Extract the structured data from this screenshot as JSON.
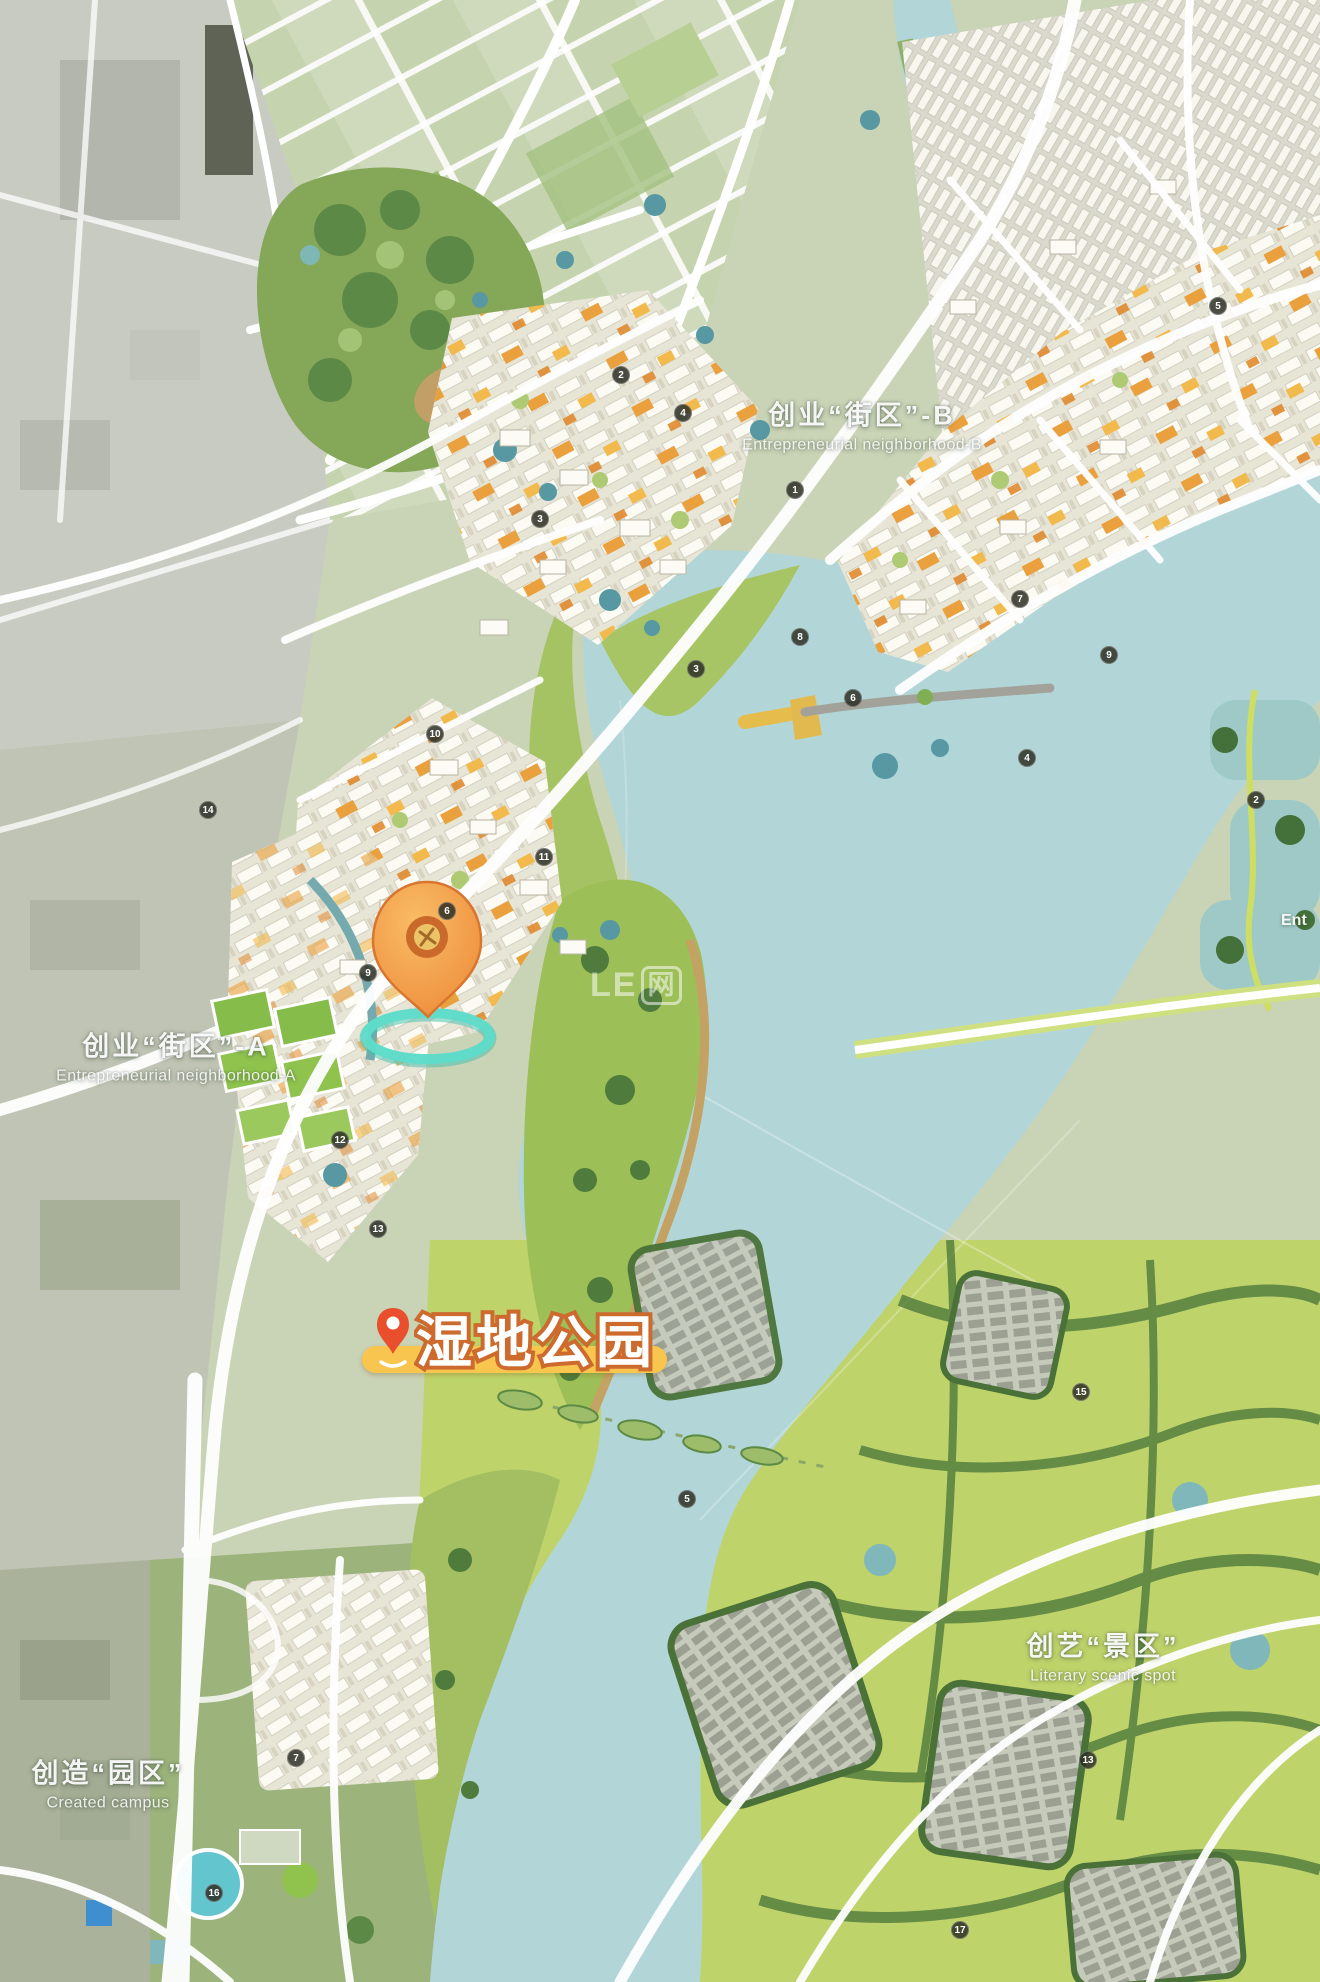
{
  "meta": {
    "canvas": {
      "width": 1320,
      "height": 1982
    },
    "kind": "urban master-plan rendering with wetland-park location tag"
  },
  "districts": [
    {
      "id": "district-b",
      "zh": "创业“街区”-B",
      "en": "Entrepreneurial neighborhood-B",
      "x": 862,
      "y": 424
    },
    {
      "id": "district-a",
      "zh": "创业“街区”-A",
      "en": "Entrepreneurial neighborhood-A",
      "x": 176,
      "y": 1055
    },
    {
      "id": "scenic-area",
      "zh": "创艺“景区”",
      "en": "Literary scenic spot",
      "x": 1103,
      "y": 1655
    },
    {
      "id": "campus",
      "zh": "创造“园区”",
      "en": "Created campus",
      "x": 108,
      "y": 1782
    }
  ],
  "edge_label": {
    "text": "Ent",
    "x": 1281,
    "y": 912
  },
  "poi_tag": {
    "text": "湿地公园"
  },
  "watermark": {
    "latin": "LE",
    "cjk": "网"
  },
  "pin": {
    "x": 427,
    "y": 1016
  },
  "markers": [
    {
      "x": 621,
      "y": 375,
      "n": "2"
    },
    {
      "x": 683,
      "y": 413,
      "n": "4"
    },
    {
      "x": 795,
      "y": 490,
      "n": "1"
    },
    {
      "x": 540,
      "y": 519,
      "n": "3"
    },
    {
      "x": 696,
      "y": 669,
      "n": "3"
    },
    {
      "x": 800,
      "y": 637,
      "n": "8"
    },
    {
      "x": 853,
      "y": 698,
      "n": "6"
    },
    {
      "x": 1027,
      "y": 758,
      "n": "4"
    },
    {
      "x": 1020,
      "y": 599,
      "n": "7"
    },
    {
      "x": 1109,
      "y": 655,
      "n": "9"
    },
    {
      "x": 1256,
      "y": 800,
      "n": "2"
    },
    {
      "x": 1218,
      "y": 306,
      "n": "5"
    },
    {
      "x": 435,
      "y": 734,
      "n": "10"
    },
    {
      "x": 208,
      "y": 810,
      "n": "14"
    },
    {
      "x": 544,
      "y": 857,
      "n": "11"
    },
    {
      "x": 447,
      "y": 911,
      "n": "6"
    },
    {
      "x": 368,
      "y": 973,
      "n": "9"
    },
    {
      "x": 340,
      "y": 1140,
      "n": "12"
    },
    {
      "x": 378,
      "y": 1229,
      "n": "13"
    },
    {
      "x": 687,
      "y": 1499,
      "n": "5"
    },
    {
      "x": 1081,
      "y": 1392,
      "n": "15"
    },
    {
      "x": 1088,
      "y": 1760,
      "n": "13"
    },
    {
      "x": 296,
      "y": 1758,
      "n": "7"
    },
    {
      "x": 214,
      "y": 1893,
      "n": "16"
    },
    {
      "x": 960,
      "y": 1930,
      "n": "17"
    }
  ],
  "colors": {
    "water": "#b2d6d8",
    "tag_bg": "#f8c64e",
    "tag_text_stroke": "#cd6a2e",
    "pin_body": "#f09a44",
    "pin_red": "#e94f2c",
    "halo": "#5fdcca",
    "marker_bg": "#2a2c23"
  }
}
